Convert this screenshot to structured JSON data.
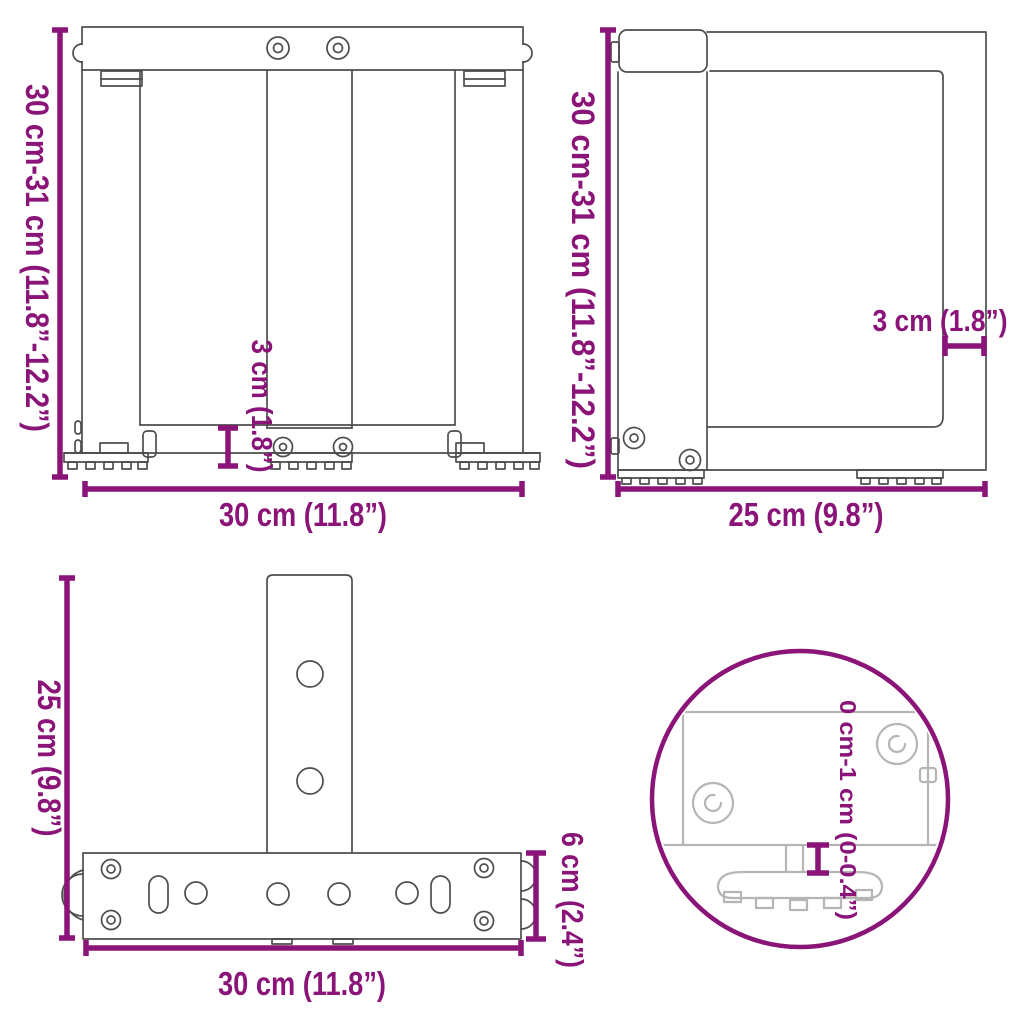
{
  "title": "Table leg dimensions diagram",
  "colors": {
    "dimension": "#8A1478",
    "line": "#4d4d4d",
    "detail_line": "#b5b5b5",
    "background": "#ffffff"
  },
  "views": {
    "front": {
      "height": "30 cm-31 cm (11.8”-12.2”)",
      "width": "30 cm (11.8”)",
      "foot_height": "3 cm (1.8”)"
    },
    "side": {
      "height": "30 cm-31 cm (11.8”-12.2”)",
      "depth": "25 cm (9.8”)",
      "profile_width": "3 cm (1.8”)"
    },
    "top": {
      "depth": "25 cm (9.8”)",
      "width": "30 cm (11.8”)",
      "bar_depth": "6 cm (2.4”)"
    },
    "detail": {
      "adjust_range": "0 cm-1 cm (0-0.4”)"
    }
  }
}
